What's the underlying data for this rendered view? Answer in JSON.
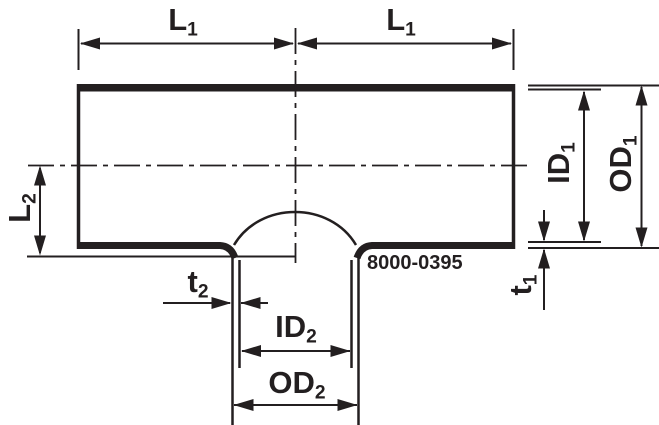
{
  "drawing": {
    "part_number": "8000-0395",
    "labels": {
      "l1_left": {
        "main": "L",
        "sub": "1"
      },
      "l1_right": {
        "main": "L",
        "sub": "1"
      },
      "l2": {
        "main": "L",
        "sub": "2"
      },
      "t2": {
        "main": "t",
        "sub": "2"
      },
      "id2": {
        "main": "ID",
        "sub": "2"
      },
      "od2": {
        "main": "OD",
        "sub": "2"
      },
      "id1": {
        "main": "ID",
        "sub": "1"
      },
      "od1": {
        "main": "OD",
        "sub": "1"
      },
      "t1": {
        "main": "t",
        "sub": "1"
      }
    }
  },
  "colors": {
    "ink": "#231f20",
    "background": "#ffffff"
  }
}
